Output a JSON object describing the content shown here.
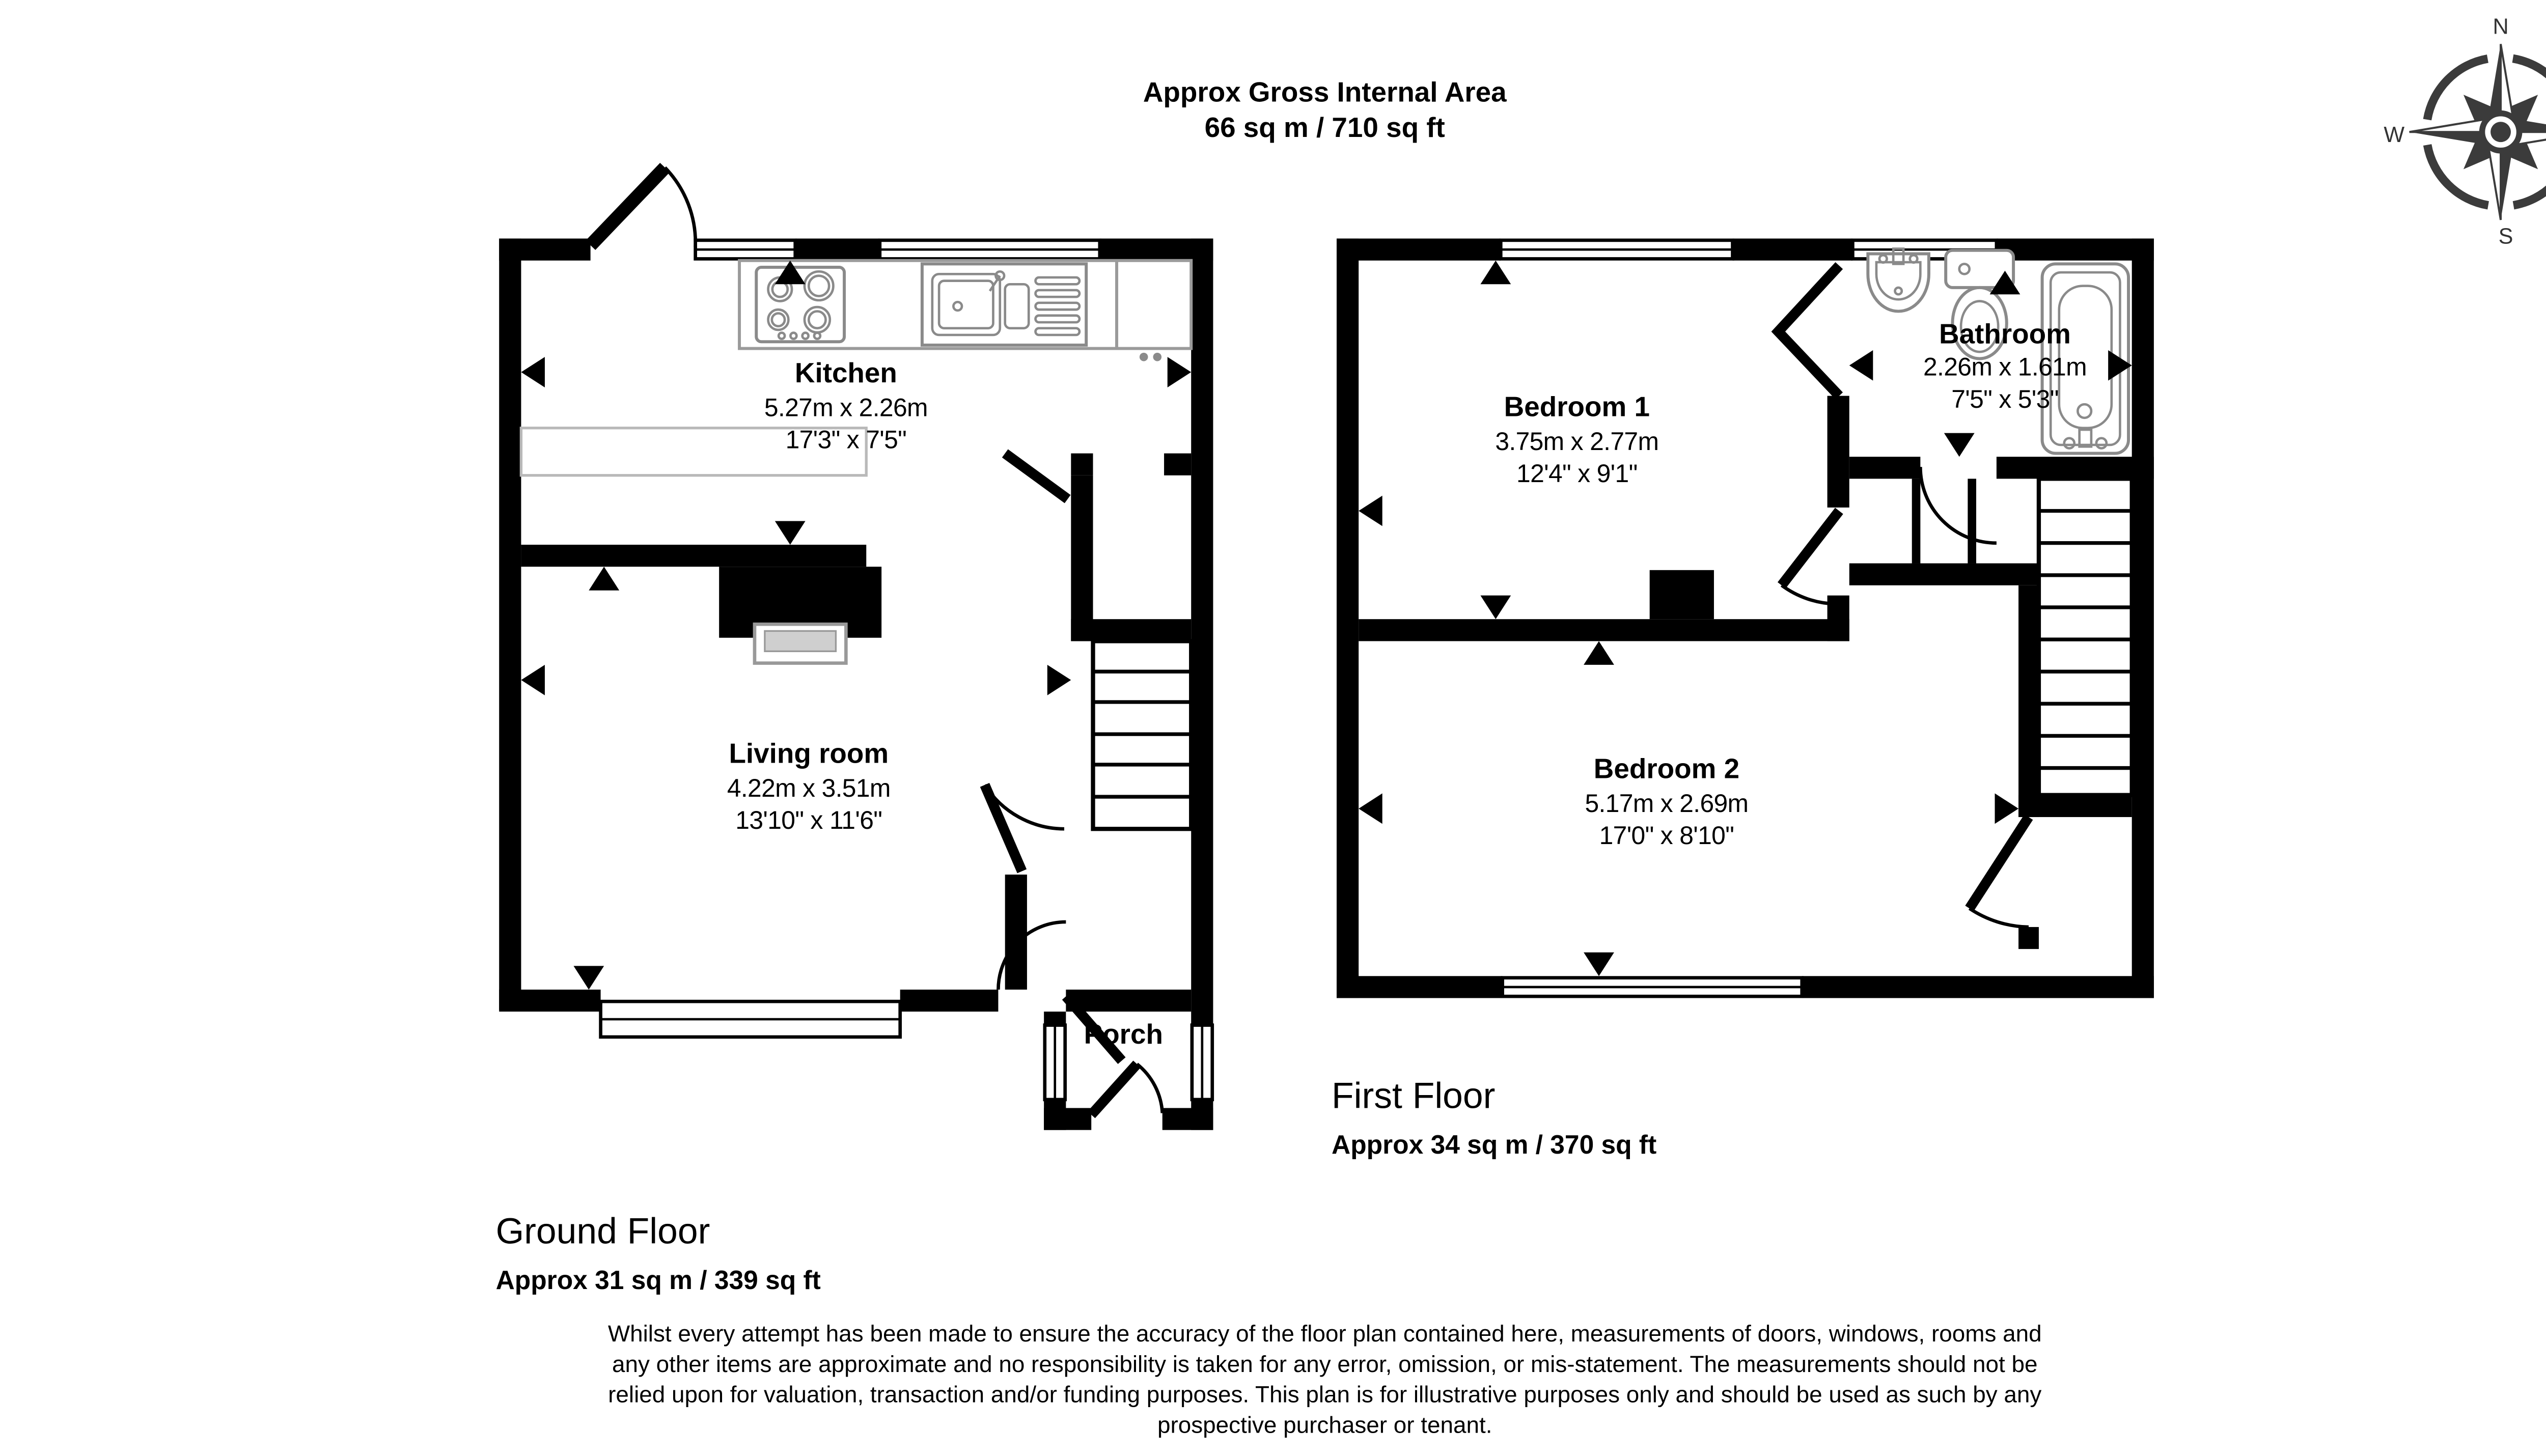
{
  "title": {
    "line1": "Approx Gross Internal Area",
    "line2": "66 sq m / 710 sq ft"
  },
  "compass": {
    "n": "N",
    "e": "E",
    "s": "S",
    "w": "W"
  },
  "ground_floor": {
    "label": "Ground Floor",
    "area": "Approx 31 sq m / 339 sq ft",
    "rooms": {
      "kitchen": {
        "name": "Kitchen",
        "metric": "5.27m x 2.26m",
        "imperial": "17'3\" x 7'5\""
      },
      "living_room": {
        "name": "Living room",
        "metric": "4.22m x 3.51m",
        "imperial": "13'10\" x 11'6\""
      },
      "porch": {
        "name": "Porch"
      }
    }
  },
  "first_floor": {
    "label": "First Floor",
    "area": "Approx 34 sq m / 370 sq ft",
    "rooms": {
      "bedroom1": {
        "name": "Bedroom 1",
        "metric": "3.75m x 2.77m",
        "imperial": "12'4\" x 9'1\""
      },
      "bedroom2": {
        "name": "Bedroom 2",
        "metric": "5.17m x 2.69m",
        "imperial": "17'0\" x 8'10\""
      },
      "bathroom": {
        "name": "Bathroom",
        "metric": "2.26m x 1.61m",
        "imperial": "7'5\" x 5'3\""
      }
    }
  },
  "disclaimer": {
    "line1": "Whilst every attempt has been made to ensure the accuracy of the floor plan contained here, measurements of doors, windows, rooms and",
    "line2": "any other items are approximate and no responsibility is taken for any error, omission, or mis-statement. The measurements should not be",
    "line3": "relied upon for valuation, transaction and/or funding purposes. This plan is for illustrative purposes only and should be used as such by any",
    "line4": "prospective purchaser or tenant."
  },
  "colors": {
    "wall": "#000000",
    "fixture": "#8a8a8a",
    "compass": "#3b3b3b"
  }
}
